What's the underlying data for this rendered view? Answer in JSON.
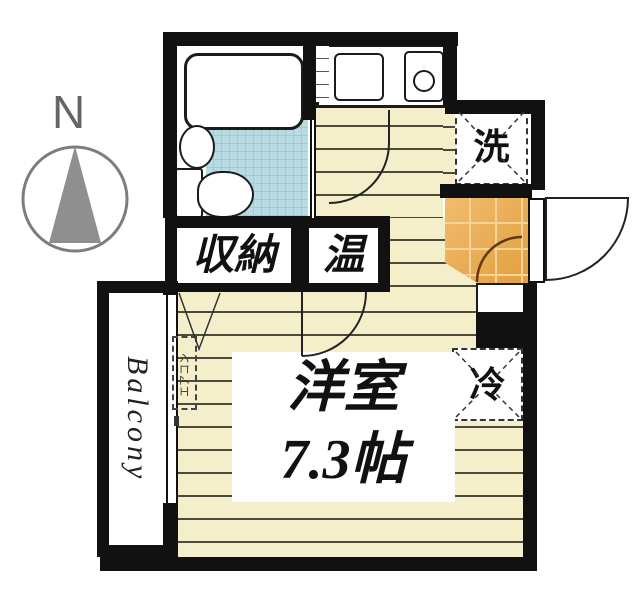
{
  "compass": {
    "label": "N"
  },
  "plan": {
    "balcony_label": "Balcony",
    "main_room_name": "洋室",
    "main_room_size": "7.3帖",
    "closet_label": "収納",
    "heater_label": "温",
    "washer_label": "洗",
    "fridge_label": "冷",
    "aircon_label": "エアコン"
  },
  "colors": {
    "wall": "#111111",
    "flooring": "#f4eecb",
    "flooring_line": "#4a4a38",
    "bathroom_tile": "#b9dbe3",
    "entrance_tile": "#e9a94e",
    "entrance_door_arc": "#5f3a13",
    "compass_gray": "#8f8f8f"
  }
}
